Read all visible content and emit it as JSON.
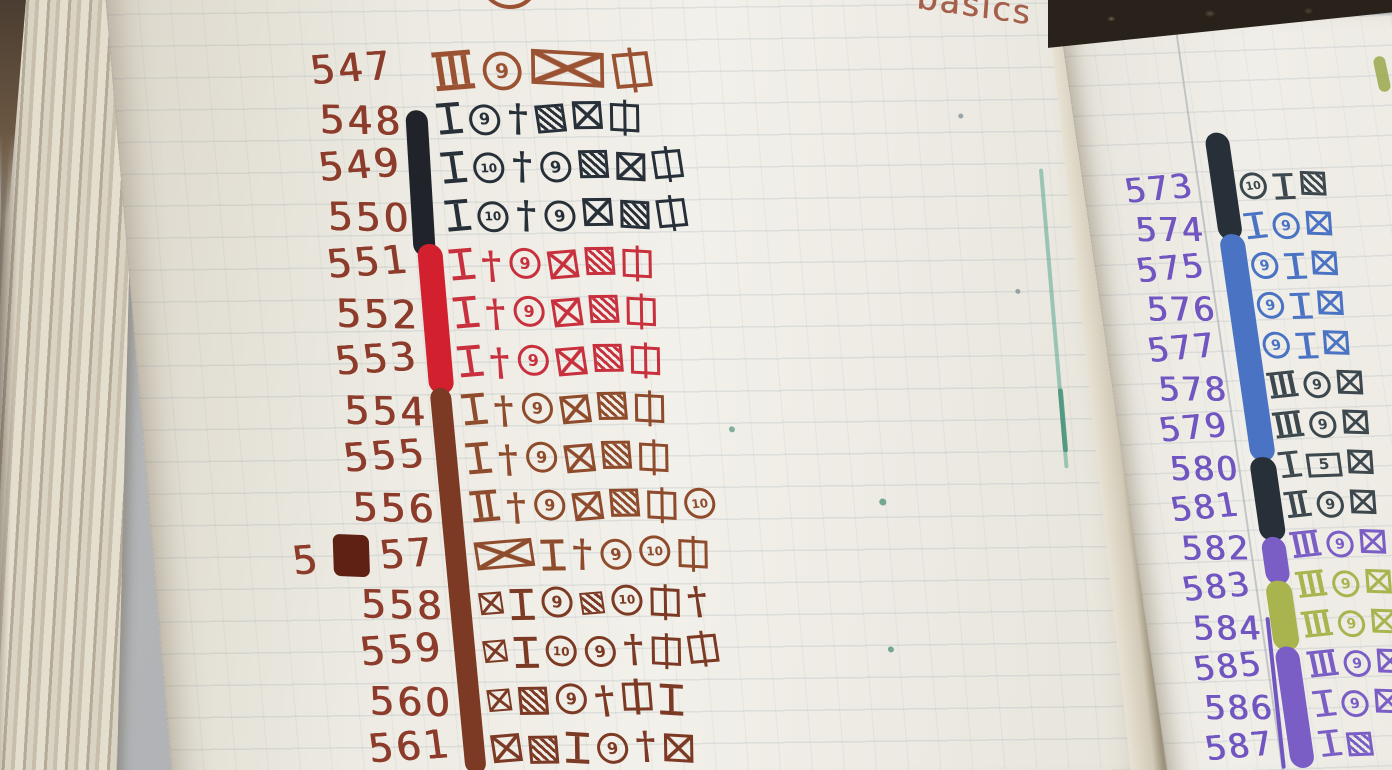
{
  "colors": {
    "number_brown": "#8d3c2b",
    "sienna": "#9a5233",
    "navy": "#272f38",
    "red": "#c8303e",
    "chestnut": "#8f4c2c",
    "maroon": "#7c3a24",
    "number_purple": "#7156c1",
    "slate": "#3c484d",
    "blue": "#4a73c4",
    "violet": "#7a5ec6",
    "olive": "#a9b44e",
    "black": "#20242a",
    "bright_red": "#d2202e",
    "teal": "#58a88f",
    "teal_dark": "#3f8f77"
  },
  "symbol_text": {
    "circled-9": "9",
    "circled-10": "10",
    "box-5": "5",
    "dagger": "†"
  },
  "left_page": {
    "heading": "basics",
    "num_ink": "number_brown",
    "stripe_segments": [
      "black",
      "bright_red",
      "maroon"
    ],
    "rows": [
      {
        "num": "547",
        "ink": "sienna",
        "symbols": [
          "tally-3",
          "circled-9",
          "crossed-box-wide",
          "lined-box"
        ]
      },
      {
        "num": "548",
        "ink": "navy",
        "symbols": [
          "i-beam",
          "circled-9",
          "dagger",
          "hatched-box",
          "crossed-box",
          "lined-box"
        ]
      },
      {
        "num": "549",
        "ink": "navy",
        "symbols": [
          "i-beam",
          "circled-10",
          "dagger",
          "circled-9",
          "hatched-box",
          "crossed-box",
          "lined-box"
        ]
      },
      {
        "num": "550",
        "ink": "navy",
        "symbols": [
          "i-beam",
          "circled-10",
          "dagger",
          "circled-9",
          "crossed-box",
          "hatched-box",
          "lined-box"
        ]
      },
      {
        "num": "551",
        "ink": "red",
        "symbols": [
          "i-beam",
          "dagger",
          "circled-9",
          "crossed-box",
          "hatched-box",
          "lined-box"
        ]
      },
      {
        "num": "552",
        "ink": "red",
        "symbols": [
          "i-beam",
          "dagger",
          "circled-9",
          "crossed-box",
          "hatched-box",
          "lined-box"
        ]
      },
      {
        "num": "553",
        "ink": "red",
        "symbols": [
          "i-beam",
          "dagger",
          "circled-9",
          "crossed-box",
          "hatched-box",
          "lined-box"
        ]
      },
      {
        "num": "554",
        "ink": "chestnut",
        "symbols": [
          "i-beam",
          "dagger",
          "circled-9",
          "crossed-box",
          "hatched-box",
          "lined-box"
        ]
      },
      {
        "num": "555",
        "ink": "chestnut",
        "symbols": [
          "i-beam",
          "dagger",
          "circled-9",
          "crossed-box",
          "hatched-box",
          "lined-box"
        ]
      },
      {
        "num": "556",
        "ink": "chestnut",
        "symbols": [
          "i-beam-2",
          "dagger",
          "circled-9",
          "crossed-box",
          "hatched-box",
          "lined-box",
          "circled-10"
        ]
      },
      {
        "num": "557",
        "blot": true,
        "prefix": "5",
        "rest": "57",
        "ink": "chestnut",
        "symbols": [
          "crossed-box-wide",
          "i-beam",
          "dagger",
          "circled-9",
          "circled-10",
          "lined-box"
        ]
      },
      {
        "num": "558",
        "ink": "maroon",
        "symbols": [
          "crossed-box-small",
          "i-beam",
          "circled-9",
          "hatched-box-small",
          "circled-10",
          "lined-box",
          "dagger"
        ]
      },
      {
        "num": "559",
        "ink": "maroon",
        "symbols": [
          "crossed-box-small",
          "i-beam",
          "circled-10",
          "circled-9",
          "dagger",
          "lined-box",
          "lined-box"
        ]
      },
      {
        "num": "560",
        "ink": "maroon",
        "symbols": [
          "crossed-box-small",
          "hatched-box",
          "circled-9",
          "dagger",
          "lined-box",
          "i-beam"
        ]
      },
      {
        "num": "561",
        "ink": "maroon",
        "symbols": [
          "crossed-box",
          "hatched-box",
          "i-beam",
          "circled-9",
          "dagger",
          "crossed-box"
        ]
      }
    ]
  },
  "right_page": {
    "num_ink": "number_purple",
    "stripe_segments": [
      "navy",
      "blue",
      "navy",
      "violet",
      "olive",
      "violet"
    ],
    "rows": [
      {
        "num": "573",
        "ink": "slate",
        "symbols": [
          "circled-10",
          "i-beam",
          "hatched-box"
        ]
      },
      {
        "num": "574",
        "ink": "blue",
        "symbols": [
          "i-beam",
          "circled-9",
          "crossed-box"
        ]
      },
      {
        "num": "575",
        "ink": "blue",
        "symbols": [
          "circled-9",
          "i-beam",
          "crossed-box"
        ]
      },
      {
        "num": "576",
        "ink": "blue",
        "symbols": [
          "circled-9",
          "i-beam",
          "crossed-box"
        ]
      },
      {
        "num": "577",
        "ink": "blue",
        "symbols": [
          "circled-9",
          "i-beam",
          "crossed-box"
        ]
      },
      {
        "num": "578",
        "ink": "slate",
        "symbols": [
          "tally-3",
          "circled-9",
          "crossed-box"
        ]
      },
      {
        "num": "579",
        "ink": "slate",
        "symbols": [
          "tally-3",
          "circled-9",
          "crossed-box"
        ]
      },
      {
        "num": "580",
        "ink": "slate",
        "symbols": [
          "i-beam",
          "box-5",
          "crossed-box"
        ]
      },
      {
        "num": "581",
        "ink": "slate",
        "symbols": [
          "i-beam-2",
          "circled-9",
          "crossed-box"
        ]
      },
      {
        "num": "582",
        "ink": "violet",
        "symbols": [
          "tally-3",
          "circled-9",
          "crossed-box"
        ]
      },
      {
        "num": "583",
        "ink": "olive",
        "symbols": [
          "tally-3",
          "circled-9",
          "crossed-box"
        ]
      },
      {
        "num": "584",
        "ink": "olive",
        "symbols": [
          "tally-3",
          "circled-9",
          "crossed-box"
        ]
      },
      {
        "num": "585",
        "ink": "violet",
        "symbols": [
          "tally-3",
          "circled-9",
          "crossed-box"
        ]
      },
      {
        "num": "586",
        "ink": "violet",
        "symbols": [
          "i-beam",
          "circled-9",
          "crossed-box"
        ]
      },
      {
        "num": "587",
        "ink": "violet",
        "symbols": [
          "i-beam",
          "hatched-box"
        ]
      }
    ]
  }
}
